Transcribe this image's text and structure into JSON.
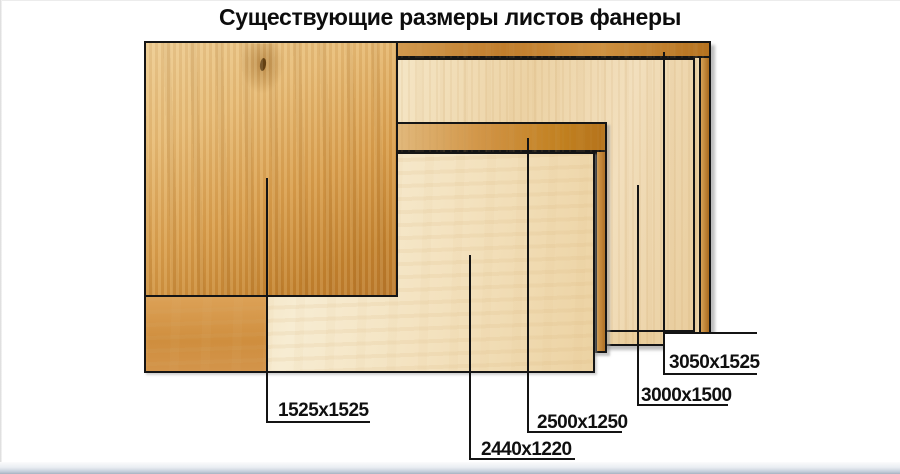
{
  "title": "Существующие размеры листов фанеры",
  "callouts": [
    {
      "id": "1525x1525",
      "size": "1525x1525"
    },
    {
      "id": "2440x1220",
      "size": "2440x1220"
    },
    {
      "id": "2500x1250",
      "size": "2500x1250"
    },
    {
      "id": "3000x1500",
      "size": "3000x1500"
    },
    {
      "id": "3050x1525",
      "size": "3050x1525"
    }
  ],
  "colors": {
    "background": "#ffffff",
    "edge_amber": "#c0801f",
    "face_pale": "#f2dfb8",
    "face_amber": "#d79b4a",
    "callout_line": "#141414",
    "bottom_bar": "#a8b2c1"
  }
}
